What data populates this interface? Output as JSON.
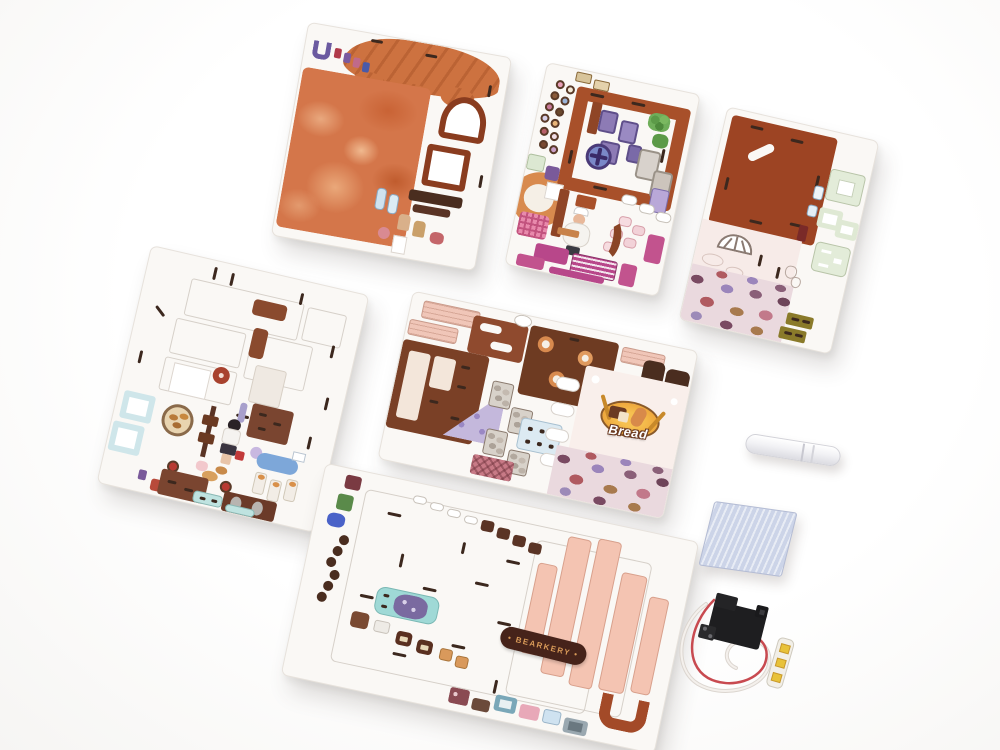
{
  "scene": {
    "description": "Six laser-cut printed plywood sheets of a DIY miniature bakery kit on a white background with a glue stick, a sanding sponge and an LED battery wire module",
    "background_color": "#ffffff"
  },
  "kit": {
    "sheet_count": 6,
    "sheets": [
      {
        "id": "sheet-top-left",
        "content": "bread-crust texture panel, scalloped bread roof, window frames"
      },
      {
        "id": "sheet-top-middle",
        "content": "sienna frame, donut stickers, purple furniture, baker figure, magenta parts"
      },
      {
        "id": "sheet-top-right",
        "content": "sienna roof panel, pale wall with fan window, cobblestone base, mint parts"
      },
      {
        "id": "sheet-middle-left",
        "content": "white cut-line panel, character stickers, furniture parts"
      },
      {
        "id": "sheet-center",
        "content": "shop front wall with Bread sign, cobblestone, shelves, plank parts"
      },
      {
        "id": "sheet-bottom",
        "content": "white base panel, salmon strips, BEARKERY plaque, small stickers"
      }
    ],
    "bread_sign": {
      "label": "Bread",
      "oval_color": "#f0a93c",
      "text_color": "#ffffff",
      "outline_color": "#6b3a22"
    },
    "bearkery_plaque": {
      "label": "• BEARKERY •",
      "bg_color": "#46231a",
      "text_color": "#d89a58"
    },
    "colors": {
      "plywood_white": "#faf8f5",
      "bread_crust": "#d4764a",
      "sienna_panel": "#9d4423",
      "pale_pink_wall": "#f7ebe8",
      "salmon_plank": "#f4c4b2",
      "dark_chocolate": "#4a2d1f",
      "magenta": "#b8478a",
      "lilac": "#8d7bb5",
      "mint": "#e3ecd9",
      "teal": "#9fd9d6",
      "stone_plum": "#7a4a62",
      "olive": "#8a7a2a"
    }
  },
  "accessories": [
    {
      "id": "glue-stick",
      "color": "#f2f2f5"
    },
    {
      "id": "sanding-sponge",
      "color": "#ccd4e8"
    },
    {
      "id": "led-battery-module",
      "body_color": "#1e1e20",
      "wire_colors": [
        "#c84a50",
        "#ece8e4"
      ],
      "led_color": "#e8c23a"
    }
  ]
}
